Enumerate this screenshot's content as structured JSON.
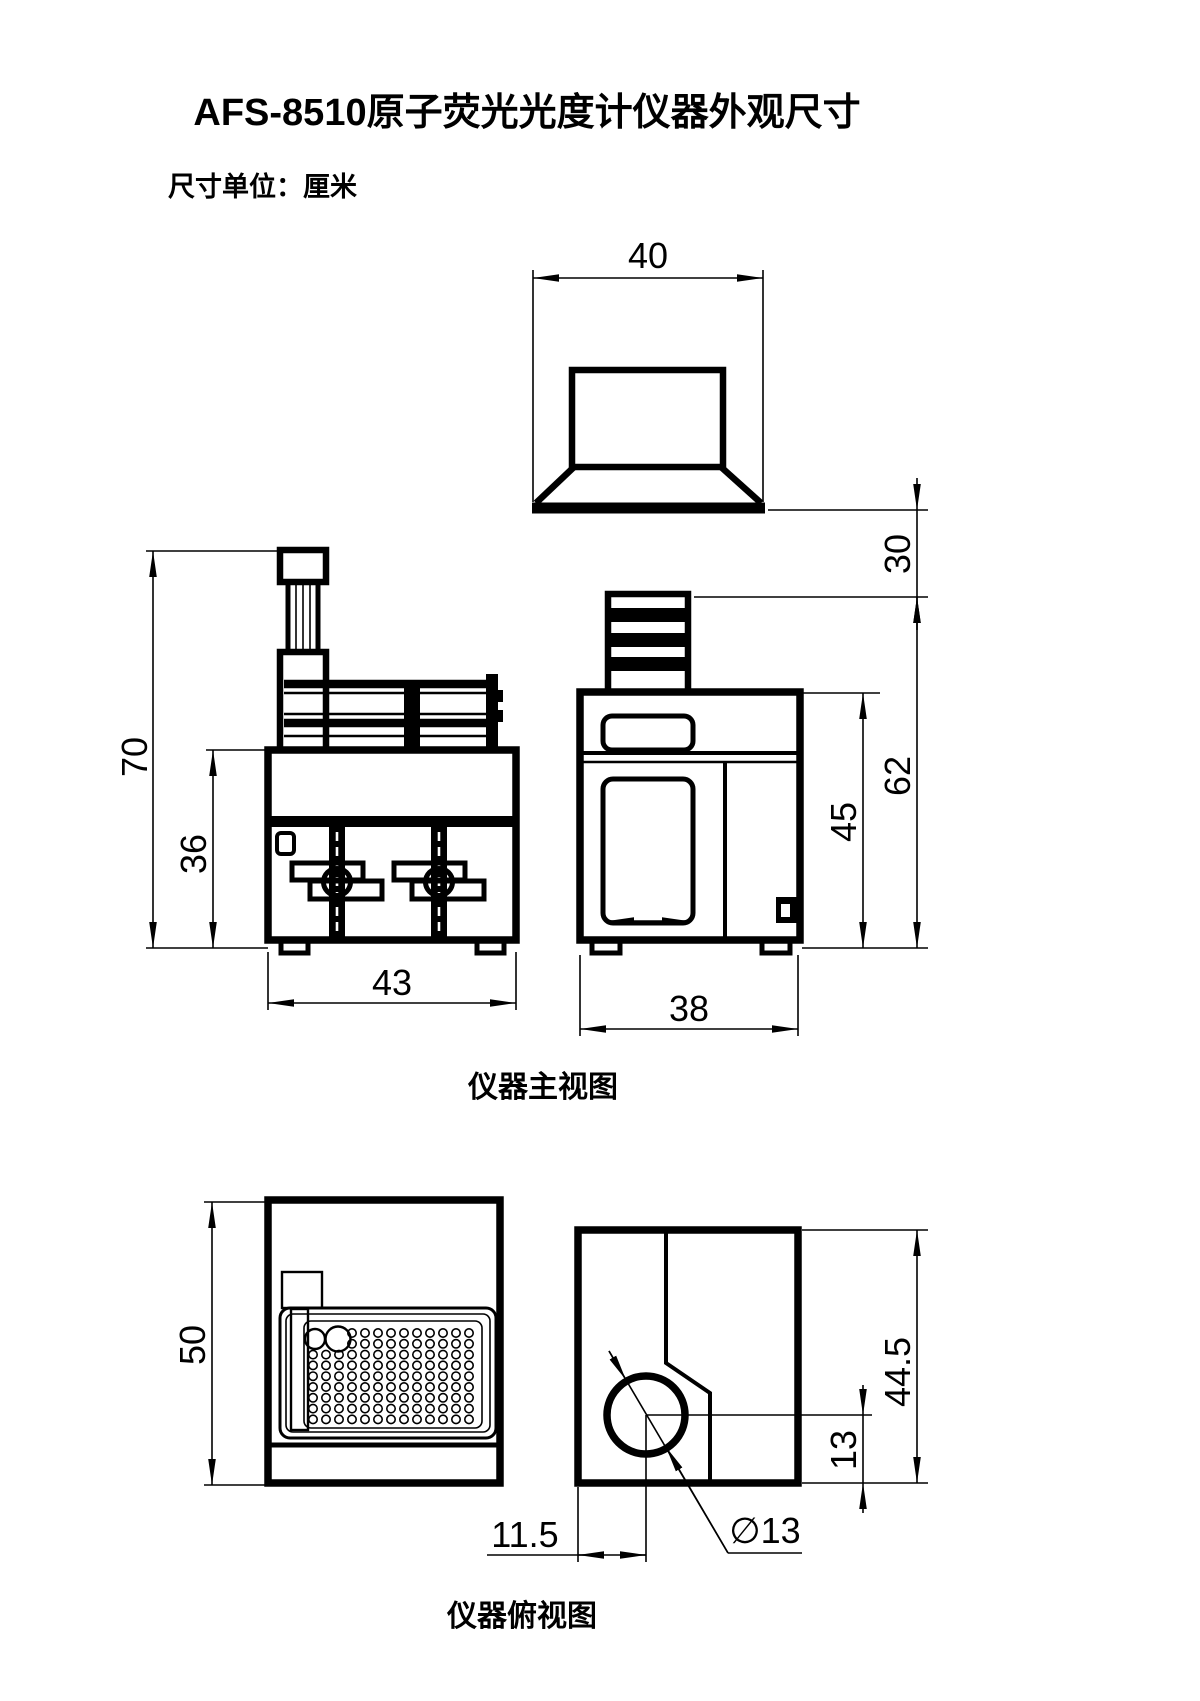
{
  "title": "AFS-8510原子荧光光度计仪器外观尺寸",
  "unit_note": "尺寸单位：厘米",
  "front_view_label": "仪器主视图",
  "top_view_label": "仪器俯视图",
  "dims": {
    "lamp_width": "40",
    "lamp_depth": "30",
    "total_height": "70",
    "body_height": "36",
    "front_width": "43",
    "right_width": "38",
    "right_total_height": "62",
    "right_body_height": "45",
    "sampler_depth": "50",
    "main_depth": "44.5",
    "hole_from_bottom": "13",
    "hole_from_left": "11.5",
    "hole_diameter": "∅13"
  },
  "colors": {
    "ink": "#000000",
    "paper": "#ffffff"
  },
  "sampler_tray": {
    "rows": 9,
    "cols": 13,
    "x0": 313,
    "y0": 1333,
    "dx": 13,
    "dy": 10.8,
    "hole_r": 4.2,
    "skip_cols_first_two_rows": 3,
    "big_circles": [
      {
        "cx": 315,
        "cy": 1339,
        "r": 10
      },
      {
        "cx": 338,
        "cy": 1339,
        "r": 12.5
      }
    ]
  }
}
